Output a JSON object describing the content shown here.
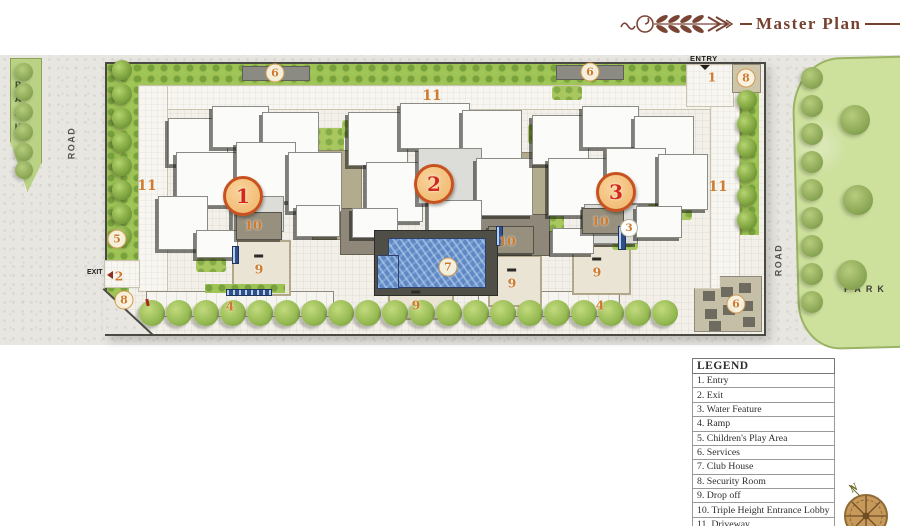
{
  "title": {
    "text": "Master Plan"
  },
  "plan": {
    "labels": {
      "park_left": "PARK",
      "park_right": "PARK",
      "road_left": "ROAD",
      "road_right": "ROAD",
      "entry": "ENTRY",
      "exit": "EXIT"
    },
    "markers": [
      {
        "n": "1",
        "type": "building",
        "x": 243,
        "y": 196
      },
      {
        "n": "2",
        "type": "building",
        "x": 434,
        "y": 184
      },
      {
        "n": "3",
        "type": "building",
        "x": 616,
        "y": 192
      },
      {
        "n": "5",
        "type": "circle",
        "x": 117,
        "y": 239
      },
      {
        "n": "8",
        "type": "circle",
        "x": 124,
        "y": 300
      },
      {
        "n": "8",
        "type": "circle",
        "x": 746,
        "y": 78
      },
      {
        "n": "6",
        "type": "circle",
        "x": 275,
        "y": 73
      },
      {
        "n": "6",
        "type": "circle",
        "x": 590,
        "y": 72
      },
      {
        "n": "6",
        "type": "circle",
        "x": 736,
        "y": 304
      },
      {
        "n": "7",
        "type": "circle",
        "x": 448,
        "y": 267
      },
      {
        "n": "3",
        "type": "circle-white",
        "x": 629,
        "y": 228
      },
      {
        "n": "1",
        "type": "num",
        "x": 712,
        "y": 77
      },
      {
        "n": "2",
        "type": "num",
        "x": 119,
        "y": 276
      },
      {
        "n": "4",
        "type": "num",
        "x": 230,
        "y": 306
      },
      {
        "n": "4",
        "type": "num",
        "x": 600,
        "y": 305
      },
      {
        "n": "9",
        "type": "num-arrow",
        "x": 259,
        "y": 269
      },
      {
        "n": "9",
        "type": "num-arrow",
        "x": 416,
        "y": 305
      },
      {
        "n": "9",
        "type": "num-arrow",
        "x": 512,
        "y": 283
      },
      {
        "n": "9",
        "type": "num-arrow",
        "x": 597,
        "y": 272
      },
      {
        "n": "10",
        "type": "num",
        "x": 253,
        "y": 225
      },
      {
        "n": "10",
        "type": "num",
        "x": 507,
        "y": 241
      },
      {
        "n": "10",
        "type": "num",
        "x": 600,
        "y": 221
      },
      {
        "n": "11",
        "type": "num-lg",
        "x": 147,
        "y": 186
      },
      {
        "n": "11",
        "type": "num-lg",
        "x": 432,
        "y": 96
      },
      {
        "n": "11",
        "type": "num-lg",
        "x": 718,
        "y": 187
      }
    ]
  },
  "legend": {
    "header": "LEGEND",
    "items": [
      "1. Entry",
      "2. Exit",
      "3. Water Feature",
      "4. Ramp",
      "5. Children's Play Area",
      "6. Services",
      "7. Club House",
      "8. Security Room",
      "9. Drop off",
      "10. Triple Height Entrance Lobby",
      "11. Driveway"
    ]
  },
  "compass": {
    "north": "N"
  },
  "colors": {
    "title_brown": "#76412f",
    "accent_orange": "#cf7b2e",
    "marker_red": "#d2291a",
    "pool_blue": "#5f88c4",
    "band_green": "#9ec254",
    "park_green": "#cde09c"
  }
}
